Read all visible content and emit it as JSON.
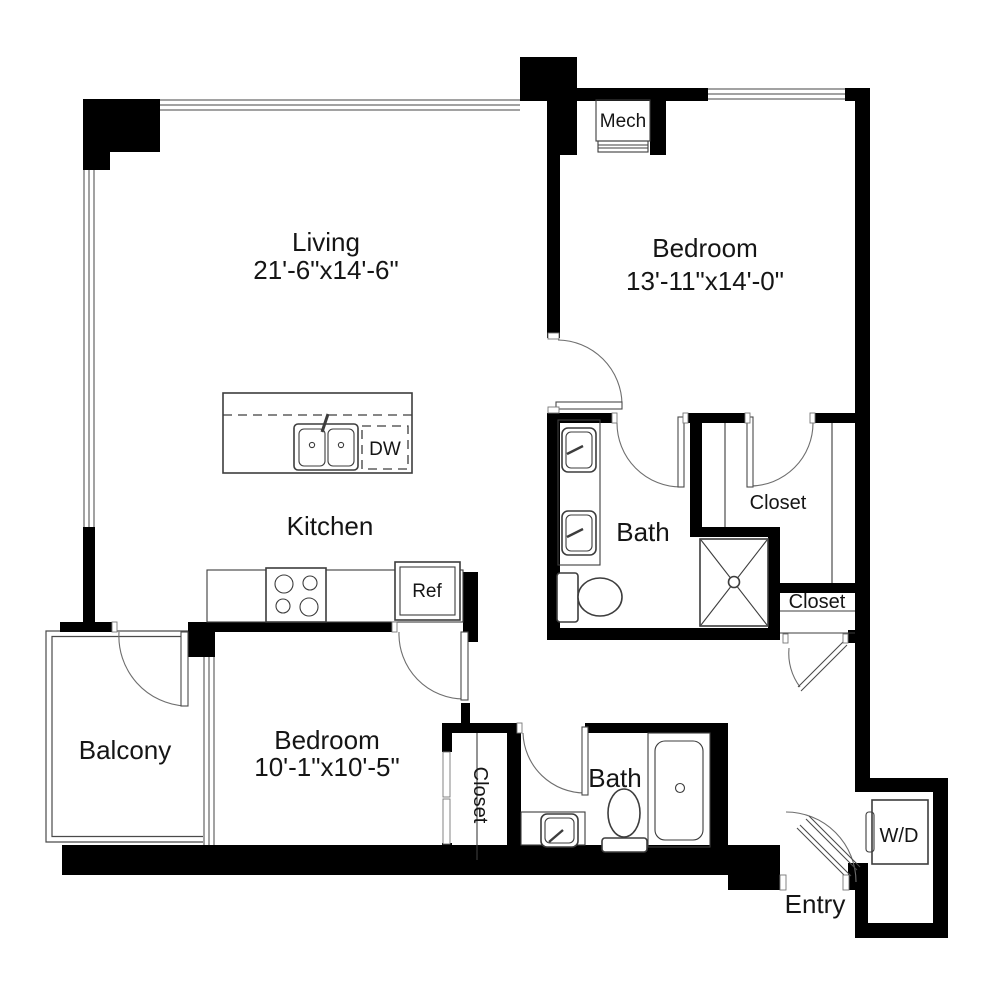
{
  "plan": {
    "rooms": {
      "living": {
        "name": "Living",
        "dims": "21'-6\"x14'-6\""
      },
      "bedroom1": {
        "name": "Bedroom",
        "dims": "13'-11\"x14'-0\""
      },
      "bedroom2": {
        "name": "Bedroom",
        "dims": "10'-1\"x10'-5\""
      },
      "kitchen": {
        "name": "Kitchen"
      },
      "bath1": {
        "name": "Bath"
      },
      "bath2": {
        "name": "Bath"
      },
      "balcony": {
        "name": "Balcony"
      },
      "entry": {
        "name": "Entry"
      },
      "mech": {
        "name": "Mech"
      },
      "closet_walkin": {
        "name": "Closet"
      },
      "closet_linen": {
        "name": "Closet"
      },
      "closet_bedroom2": {
        "name": "Closet"
      }
    },
    "appliances": {
      "dishwasher": "DW",
      "refrigerator": "Ref",
      "washer_dryer": "W/D"
    },
    "colors": {
      "walls": "#000000",
      "background": "#ffffff",
      "fixtures": "#3d3d3d"
    }
  }
}
